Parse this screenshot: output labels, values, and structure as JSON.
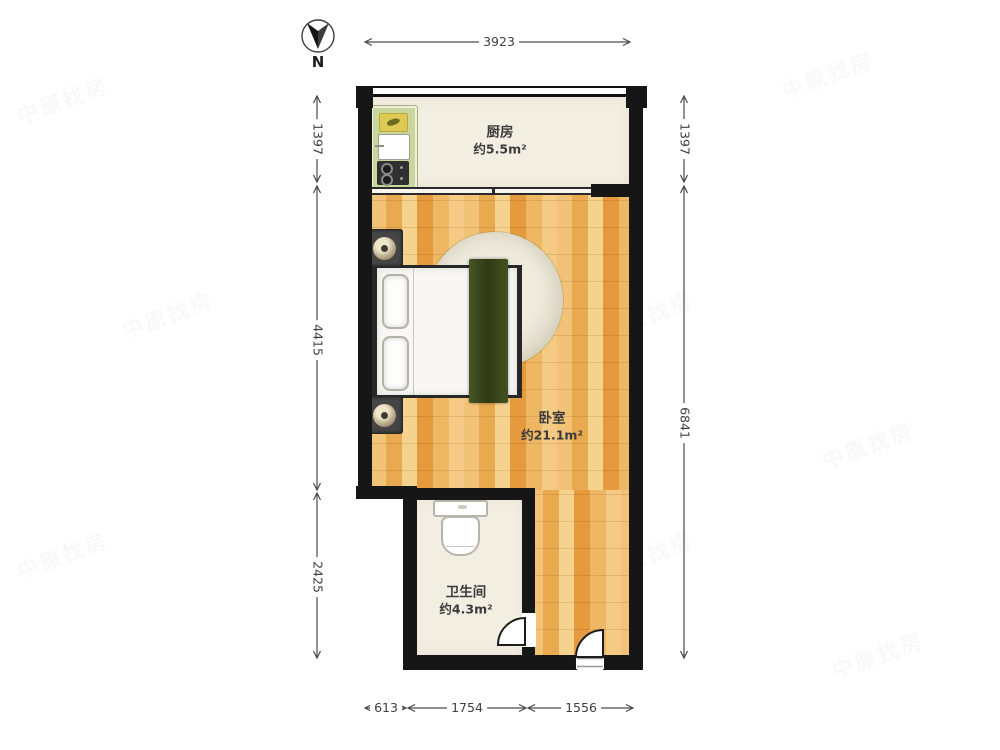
{
  "compass": {
    "label": "N"
  },
  "watermark": {
    "text": "中原找房"
  },
  "dimensions": {
    "top": [
      "3923"
    ],
    "left": [
      "1397",
      "4415",
      "2425"
    ],
    "right": [
      "1397",
      "6841"
    ],
    "bottom": [
      "613",
      "1754",
      "1556"
    ]
  },
  "rooms": {
    "kitchen": {
      "name": "厨房",
      "area": "约5.5m²"
    },
    "bedroom": {
      "name": "卧室",
      "area": "约21.1m²"
    },
    "bathroom": {
      "name": "卫生间",
      "area": "约4.3m²"
    }
  },
  "colors": {
    "wall": "#161616",
    "wood_floor": "#eeb25c",
    "tile_floor": "#f3eee2",
    "counter": "#c9d69c",
    "blanket": "#3c4a1e",
    "dimension_line": "#4a4a4a",
    "label_text": "#3b3b3b"
  }
}
